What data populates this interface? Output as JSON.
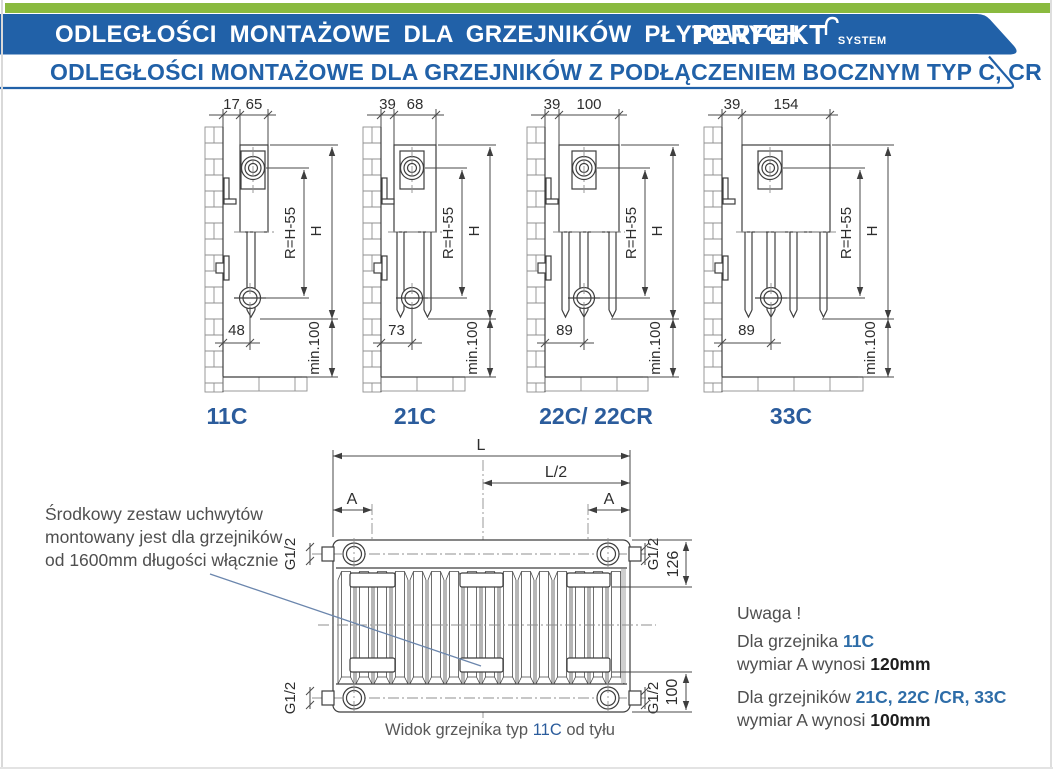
{
  "colors": {
    "green": "#8aba3f",
    "banner_blue": "#2161a8",
    "label_blue": "#2b5c9c",
    "note_blue": "#2e6da8",
    "line": "#3e3e3e"
  },
  "header": {
    "title": "ODLEGŁOŚCI MONTAŻOWE DLA GRZEJNIKÓW PŁYTOWYCH",
    "logo": "PERFEKT",
    "logo_sub": "SYSTEM",
    "subtitle": "ODLEGŁOŚCI MONTAŻOWE DLA GRZEJNIKÓW Z PODŁĄCZENIEM BOCZNYM TYP C, CR"
  },
  "side_views": [
    {
      "label": "11C",
      "dim_wall": "17",
      "dim_depth": "65",
      "dim_bottom": "48",
      "dim_r": "R=H-55",
      "dim_h": "H",
      "dim_min": "min.100"
    },
    {
      "label": "21C",
      "dim_wall": "39",
      "dim_depth": "68",
      "dim_bottom": "73",
      "dim_r": "R=H-55",
      "dim_h": "H",
      "dim_min": "min.100"
    },
    {
      "label": "22C/ 22CR",
      "dim_wall": "39",
      "dim_depth": "100",
      "dim_bottom": "89",
      "dim_r": "R=H-55",
      "dim_h": "H",
      "dim_min": "min.100"
    },
    {
      "label": "33C",
      "dim_wall": "39",
      "dim_depth": "154",
      "dim_bottom": "89",
      "dim_r": "R=H-55",
      "dim_h": "H",
      "dim_min": "min.100"
    }
  ],
  "rear_view": {
    "dim_l": "L",
    "dim_l2": "L/2",
    "dim_a_left": "A",
    "dim_a_right": "A",
    "dim_g_tl": "G1/2",
    "dim_g_tr": "G1/2",
    "dim_g_bl": "G1/2",
    "dim_g_br": "G1/2",
    "dim_126": "126",
    "dim_100": "100"
  },
  "caption": {
    "prefix": "Widok grzejnika typ ",
    "type": "11C",
    "suffix": " od tyłu"
  },
  "notes": {
    "left": [
      "Środkowy zestaw uchwytów",
      "montowany jest dla grzejników",
      "od 1600mm długości włącznie"
    ],
    "uwaga": "Uwaga !",
    "n1a": "Dla grzejnika ",
    "n1b": "11C",
    "n2a": "wymiar A wynosi ",
    "n2b": "120mm",
    "n3a": "Dla grzejników ",
    "n3b": "21C, 22C /CR, 33C",
    "n4a": "wymiar A wynosi ",
    "n4b": "100mm"
  }
}
